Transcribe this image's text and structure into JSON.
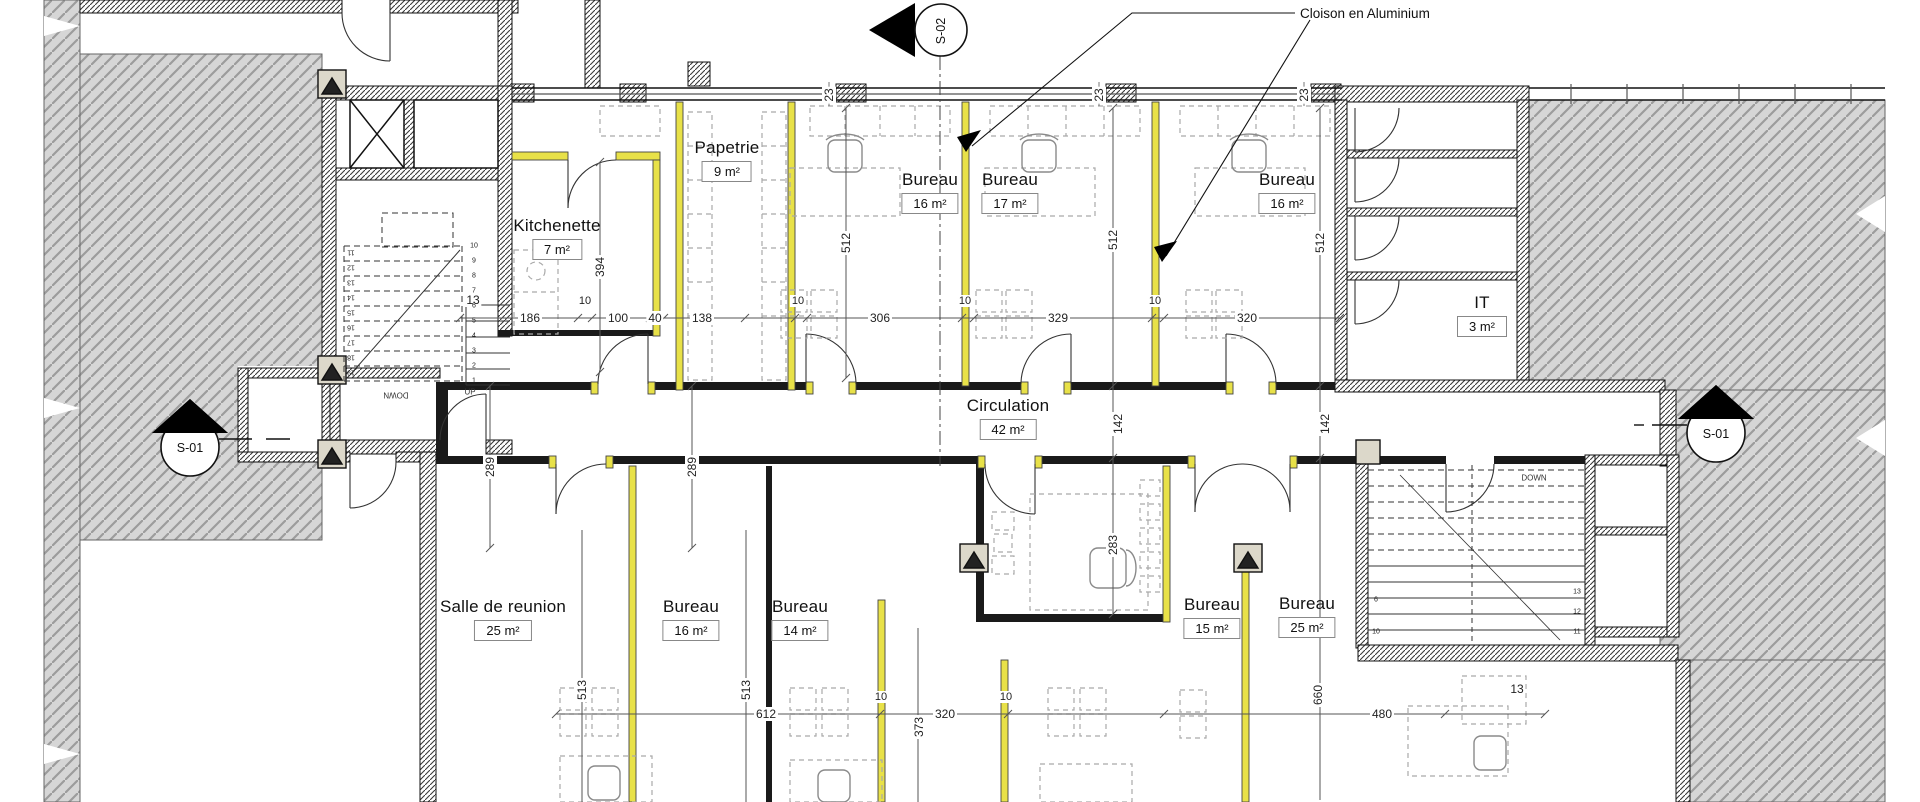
{
  "annotation": {
    "cloison": "Cloison en Aluminium"
  },
  "markers": {
    "s01_left": "S-01",
    "s01_right": "S-01",
    "s02": "S-02"
  },
  "rooms": {
    "papetrie": {
      "name": "Papetrie",
      "area": "9 m²"
    },
    "kitchenette": {
      "name": "Kitchenette",
      "area": "7 m²"
    },
    "bureau_top_1": {
      "name": "Bureau",
      "area": "16 m²"
    },
    "bureau_top_2": {
      "name": "Bureau",
      "area": "17 m²"
    },
    "bureau_top_3": {
      "name": "Bureau",
      "area": "16 m²"
    },
    "it": {
      "name": "IT",
      "area": "3 m²"
    },
    "circulation": {
      "name": "Circulation",
      "area": "42 m²"
    },
    "salle_de_reunion": {
      "name": "Salle de reunion",
      "area": "25 m²"
    },
    "bureau_bottom_1": {
      "name": "Bureau",
      "area": "16 m²"
    },
    "bureau_bottom_2": {
      "name": "Bureau",
      "area": "14 m²"
    },
    "bureau_bottom_3": {
      "name": "Bureau",
      "area": "15 m²"
    },
    "bureau_bottom_4": {
      "name": "Bureau",
      "area": "25 m²"
    }
  },
  "dimensions": {
    "top_wall": [
      "23",
      "23",
      "23"
    ],
    "mid_row": [
      "13",
      "186",
      "10",
      "100",
      "40",
      "138",
      "10",
      "306",
      "10",
      "329",
      "10",
      "320"
    ],
    "vertical": [
      "394",
      "512",
      "512",
      "512",
      "289",
      "289",
      "142",
      "142",
      "283",
      "373",
      "660",
      "513",
      "513"
    ],
    "bottom_row": [
      "612",
      "10",
      "320",
      "10",
      "480",
      "13"
    ]
  },
  "stairs": {
    "up_label": "UP",
    "down_label_left": "DOWN",
    "down_label_right": "DOWN",
    "left_numbers_right_col": [
      "1",
      "2",
      "3",
      "4",
      "5",
      "6",
      "7",
      "8",
      "9",
      "10"
    ],
    "left_numbers_left_col": [
      "11",
      "12",
      "13",
      "14",
      "15",
      "16",
      "17",
      "18",
      "19"
    ],
    "right_numbers_left_col": [
      "6",
      "10"
    ],
    "right_numbers_right_col": [
      "13",
      "12",
      "11"
    ]
  },
  "colors": {
    "partition_yellow": "#e8e148",
    "exterior_hatch": "#d6d6d6",
    "wall": "#111111"
  }
}
